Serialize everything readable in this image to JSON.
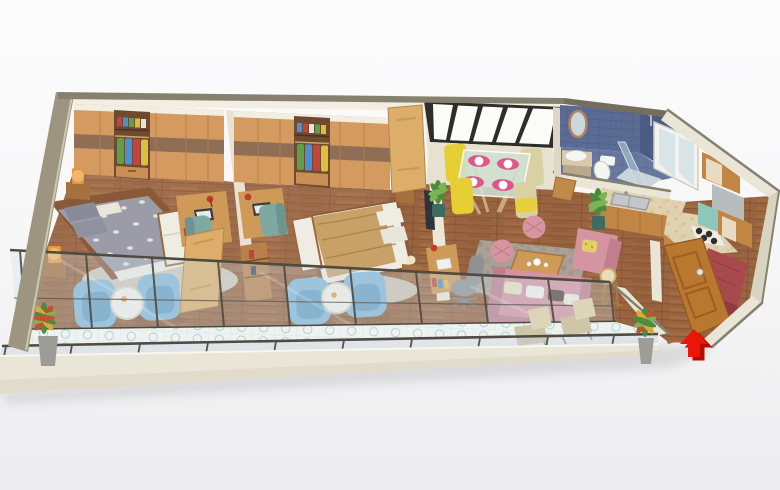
{
  "scene": {
    "description": "Isometric 3D rendered floor plan of a long one-storey apartment with front balcony",
    "view": "isometric-3d-render",
    "entrance_marker": "red arrow pointing at open entrance door, bottom right",
    "rooms": [
      {
        "name": "bedroom-left",
        "furniture": [
          "full-wall wardrobe with open clothes rail (green, blue, red, yellow clothes)",
          "double bed with gray leaf-pattern bedding and white sheet",
          "two wooden nightstands with orange lamps",
          "foot bench with white cushion",
          "desk with laptop, red lamp and teal chair",
          "two blue armchairs with round white side table",
          "light round rug"
        ]
      },
      {
        "name": "bedroom-middle",
        "furniture": [
          "full-wall wardrobe with open clothes rail",
          "double bed with tan duvet and white pillows",
          "nightstands with cream ball lamps",
          "foot bench with white cushion",
          "desk with laptop, red lamp and teal chair",
          "wall-mounted TV on partition",
          "two blue armchairs with round white side table",
          "open wooden doors",
          "low bookshelf on partition"
        ]
      },
      {
        "name": "dining-area",
        "furniture": [
          "glass-top dining table with wooden legs",
          "four yellow chairs",
          "four pink placemats with white plates",
          "large five-pane back window",
          "potted plant"
        ]
      },
      {
        "name": "living-room",
        "furniture": [
          "pink three-seat sofa with throw pillows",
          "pink armchair with yellow cushion",
          "two pink tufted poufs",
          "wooden coffee table with tea set",
          "patterned gray rug",
          "desk with laptop, red lamp and gray office chair",
          "wooden baby high chair",
          "potted plant"
        ]
      },
      {
        "name": "bathroom",
        "furniture": [
          "blue tiled walls and floor",
          "oval wood-framed mirror",
          "washbasin on cabinet",
          "toilet",
          "walk-in shower with glass panel and tray",
          "small window",
          "open wooden door"
        ]
      },
      {
        "name": "kitchen",
        "furniture": [
          "L-shaped travertine counter",
          "double-bowl steel sink",
          "four-burner gas hob",
          "wooden base and wall cabinets",
          "gray appliance",
          "mint appliance",
          "white glazed balcony door"
        ]
      },
      {
        "name": "entry",
        "furniture": [
          "open wooden entrance door with round handle",
          "maroon upholstered shoe bench",
          "red entrance arrow marker"
        ]
      },
      {
        "name": "balcony",
        "furniture": [
          "full-length glass interior wall",
          "glass railing with posts",
          "pale patterned tile floor",
          "two beige lounge chairs",
          "two colorful potted plants"
        ]
      }
    ]
  },
  "palette": {
    "background": "#f4f4f6",
    "wall_cap": "#86806f",
    "wall_cap_dark": "#746e5e",
    "wall_cream": "#eae6d7",
    "wall_cream_dark": "#d8d4c2",
    "wall_olive_side": "#9d957f",
    "trim_white": "#f2eee2",
    "floor_wood": "#9a6440",
    "wardrobe_wood": "#d49a5f",
    "wardrobe_wood_dark": "#8f6e56",
    "wardrobe_interior": "#6e4a30",
    "clothes_green": "#5f9e4a",
    "clothes_blue": "#4f8fd0",
    "clothes_red": "#c2443c",
    "clothes_yellow": "#ddbf3e",
    "window_frame": "#2e2d2b",
    "window_pane": "#fbfbf8",
    "bath_tile": "#5a6b94",
    "bath_tile_dark": "#4d5c84",
    "bath_floor": "#67779e",
    "fixture_white": "#f5f5f2",
    "mirror_wood": "#b5835a",
    "chair_yellow": "#e5cf35",
    "chair_beige": "#d9d0a4",
    "placemat_pink": "#e0568a",
    "table_glass": "#cfe0d2",
    "sofa_pink": "#d494a2",
    "sofa_pink_dark": "#c07e8e",
    "pouf_pink": "#d795a2",
    "armchair_blue": "#85b7d8",
    "armchair_blue_dark": "#699fc4",
    "side_table_white": "#f2efe8",
    "desk_wood": "#cf9a58",
    "chair_teal": "#7fa8a2",
    "office_chair_gray": "#8e9094",
    "lamp_orange": "#e8963f",
    "lamp_red": "#c23b2e",
    "bed_gray": "#9b9ca8",
    "bed_tan": "#c7a168",
    "linen_white": "#efece4",
    "bench_wood": "#9a6a40",
    "headboard_wood": "#8a5a38",
    "rug_bedroom": "#d8d2c6",
    "rug_living": "#aaa096",
    "counter_beige": "#e0d2ae",
    "cabinet_wood": "#c18544",
    "appliance_gray": "#b9bcbd",
    "appliance_mint": "#8ec7b9",
    "stove_black": "#2e2e2c",
    "door_wood": "#b9772f",
    "door_wood_dark": "#9c5f22",
    "entry_bench_maroon": "#a8494e",
    "arrow_red": "#ec1507",
    "arrow_red_dark": "#b50d04",
    "balcony_tile": "#eef3f1",
    "balcony_tile_pattern": "#a9d0d2",
    "railing_metal": "#4f4a42",
    "glass_tint": "rgba(205,225,232,0.32)",
    "plant_green": "#4d8a3c",
    "plant_green_light": "#79b457",
    "plant_red": "#c05430",
    "plant_yellow": "#d9a93a",
    "pot_gray": "#9c9c98",
    "pot_teal": "#3e6b63",
    "tv_dark": "#30343a"
  }
}
